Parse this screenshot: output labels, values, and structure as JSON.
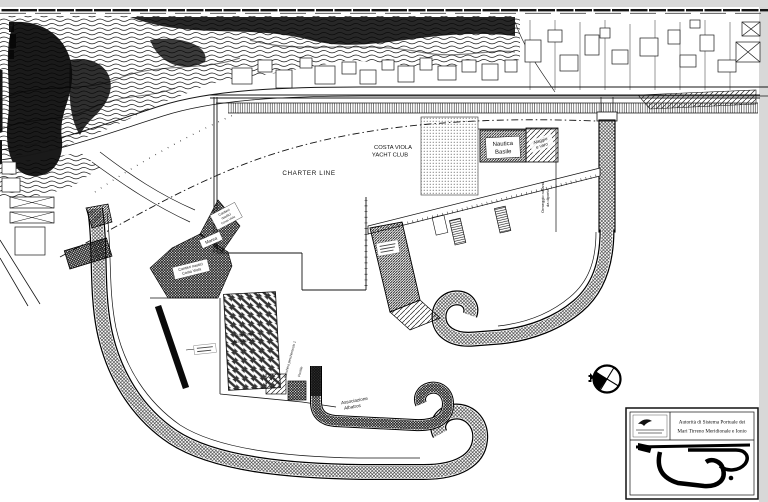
{
  "document": {
    "type": "scanned harbor plan drawing",
    "colors": {
      "paper": "#ffffff",
      "ink": "#141414",
      "scan_edge": "#d8d8d8"
    }
  },
  "map": {
    "labels": {
      "charter_line": "CHARTER LINE",
      "yacht_club": [
        "COSTA VIOLA",
        "YACHT CLUB"
      ],
      "nautica_basile": [
        "Nautica",
        "Basile"
      ],
      "alaggio": [
        "Alaggio",
        "e varo"
      ],
      "ormeggio": [
        "Ormeggio natanti",
        "da diporto"
      ],
      "cantieri_upper": [
        "Cantieri",
        "nautici",
        "Costa Viola"
      ],
      "marea": "Marea",
      "cantieri_lower": [
        "Cantieri nautici",
        "Costa Viola"
      ],
      "banchina_2": [
        "Banchina",
        "peschereccio 2"
      ],
      "banchina_1": "Banchina peschereccio 1",
      "pontile": "Pontile",
      "albatros": [
        "Associazione",
        "Albatros"
      ]
    },
    "icons": {
      "compass_rose": "circle-with-cross-and-filled-quadrant",
      "authority_logo": "bird-emblem"
    }
  },
  "title_block": {
    "authority": [
      "Autorità di Sistema Portuale dei",
      "Mari Tirreno Meridionale e Ionio"
    ]
  }
}
